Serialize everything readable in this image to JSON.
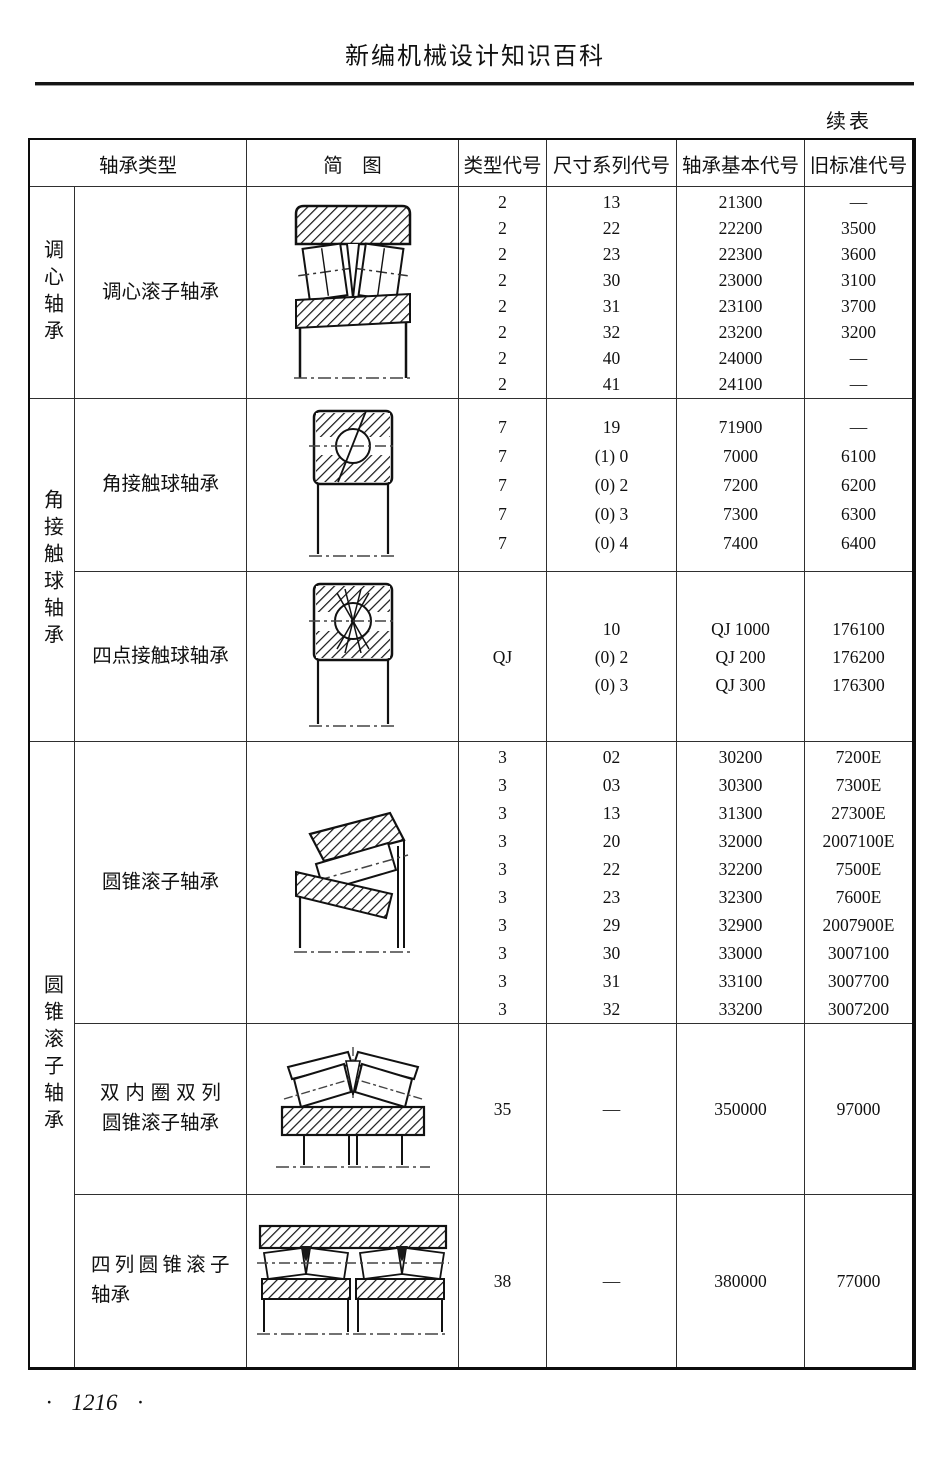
{
  "page": {
    "book_title": "新编机械设计知识百科",
    "continued_note": "续表",
    "page_number": "· 1216 ·"
  },
  "table": {
    "headers": {
      "bearing_type": "轴承类型",
      "diagram": "简　图",
      "type_code": "类型代号",
      "size_series_code": "尺寸系列代号",
      "bearing_basic_code": "轴承基本代号",
      "old_standard_code": "旧标准代号"
    },
    "groups": [
      {
        "group_name": "调心轴承",
        "rows": [
          {
            "bearing_name_lines": [
              "调心滚子轴承"
            ],
            "diagram": "spherical-roller-bearing",
            "type_codes": [
              "2",
              "2",
              "2",
              "2",
              "2",
              "2",
              "2",
              "2"
            ],
            "size_series_codes": [
              "13",
              "22",
              "23",
              "30",
              "31",
              "32",
              "40",
              "41"
            ],
            "basic_codes": [
              "21300",
              "22200",
              "22300",
              "23000",
              "23100",
              "23200",
              "24000",
              "24100"
            ],
            "old_codes": [
              "—",
              "3500",
              "3600",
              "3100",
              "3700",
              "3200",
              "—",
              "—"
            ]
          }
        ]
      },
      {
        "group_name": "角接触球轴承",
        "rows": [
          {
            "bearing_name_lines": [
              "角接触球轴承"
            ],
            "diagram": "angular-contact-ball-bearing",
            "type_codes": [
              "7",
              "7",
              "7",
              "7",
              "7"
            ],
            "size_series_codes": [
              "19",
              "(1) 0",
              "(0) 2",
              "(0) 3",
              "(0) 4"
            ],
            "basic_codes": [
              "71900",
              "7000",
              "7200",
              "7300",
              "7400"
            ],
            "old_codes": [
              "—",
              "6100",
              "6200",
              "6300",
              "6400"
            ]
          },
          {
            "bearing_name_lines": [
              "四点接触球轴承"
            ],
            "diagram": "four-point-contact-ball-bearing",
            "type_codes": [
              "QJ"
            ],
            "size_series_codes": [
              "10",
              "(0) 2",
              "(0) 3"
            ],
            "basic_codes": [
              "QJ 1000",
              "QJ 200",
              "QJ 300"
            ],
            "old_codes": [
              "176100",
              "176200",
              "176300"
            ]
          }
        ]
      },
      {
        "group_name": "圆锥滚子轴承",
        "rows": [
          {
            "bearing_name_lines": [
              "圆锥滚子轴承"
            ],
            "diagram": "tapered-roller-bearing",
            "type_codes": [
              "3",
              "3",
              "3",
              "3",
              "3",
              "3",
              "3",
              "3",
              "3",
              "3"
            ],
            "size_series_codes": [
              "02",
              "03",
              "13",
              "20",
              "22",
              "23",
              "29",
              "30",
              "31",
              "32"
            ],
            "basic_codes": [
              "30200",
              "30300",
              "31300",
              "32000",
              "32200",
              "32300",
              "32900",
              "33000",
              "33100",
              "33200"
            ],
            "old_codes": [
              "7200E",
              "7300E",
              "27300E",
              "2007100E",
              "7500E",
              "7600E",
              "2007900E",
              "3007100",
              "3007700",
              "3007200"
            ]
          },
          {
            "bearing_name_lines": [
              "双内圈双列",
              "圆锥滚子轴承"
            ],
            "diagram": "double-inner-ring-double-row-tapered-roller-bearing",
            "type_codes": [
              "35"
            ],
            "size_series_codes": [
              "—"
            ],
            "basic_codes": [
              "350000"
            ],
            "old_codes": [
              "97000"
            ]
          },
          {
            "bearing_name_lines": [
              "四列圆锥滚子",
              "轴承"
            ],
            "diagram": "four-row-tapered-roller-bearing",
            "type_codes": [
              "38"
            ],
            "size_series_codes": [
              "—"
            ],
            "basic_codes": [
              "380000"
            ],
            "old_codes": [
              "77000"
            ]
          }
        ]
      }
    ]
  }
}
